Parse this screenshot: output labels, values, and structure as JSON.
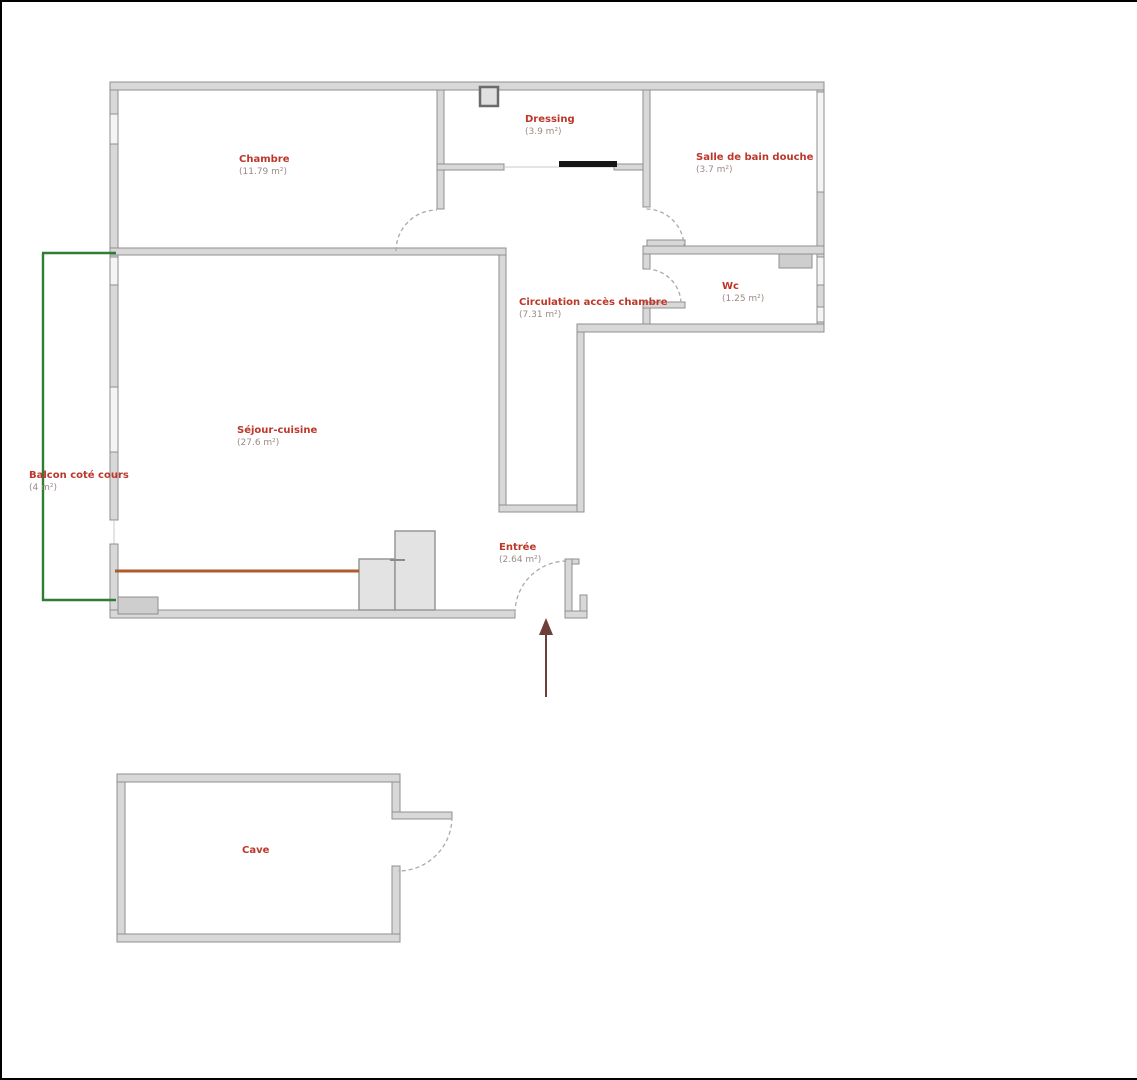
{
  "title": "Plan d'appartement",
  "theme": {
    "frame": "#000000",
    "wall-fill": "#d8d8d8",
    "wall-stroke": "#8f8f8f",
    "room-name": "#bd362a",
    "room-area": "#9c8a84",
    "balcony": "#2e7d32",
    "counter": "#b05a2a",
    "arrow": "#6e3f3a",
    "arc": "#b0a8a2",
    "slider": "#161616"
  },
  "plan": {
    "rooms": [
      {
        "id": "chambre",
        "name": "Chambre",
        "area": "(11.79 m²)"
      },
      {
        "id": "dressing",
        "name": "Dressing",
        "area": "(3.9 m²)"
      },
      {
        "id": "salle-bain",
        "name": "Salle de bain douche",
        "area": "(3.7 m²)"
      },
      {
        "id": "wc",
        "name": "Wc",
        "area": "(1.25 m²)"
      },
      {
        "id": "circulation",
        "name": "Circulation accès chambre",
        "area": "(7.31 m²)"
      },
      {
        "id": "sejour",
        "name": "Séjour-cuisine",
        "area": "(27.6 m²)"
      },
      {
        "id": "balcon",
        "name": "Balcon coté cours",
        "area": "(4 m²)"
      },
      {
        "id": "entree",
        "name": "Entrée",
        "area": "(2.64 m²)"
      },
      {
        "id": "cave",
        "name": "Cave",
        "area": ""
      }
    ]
  }
}
